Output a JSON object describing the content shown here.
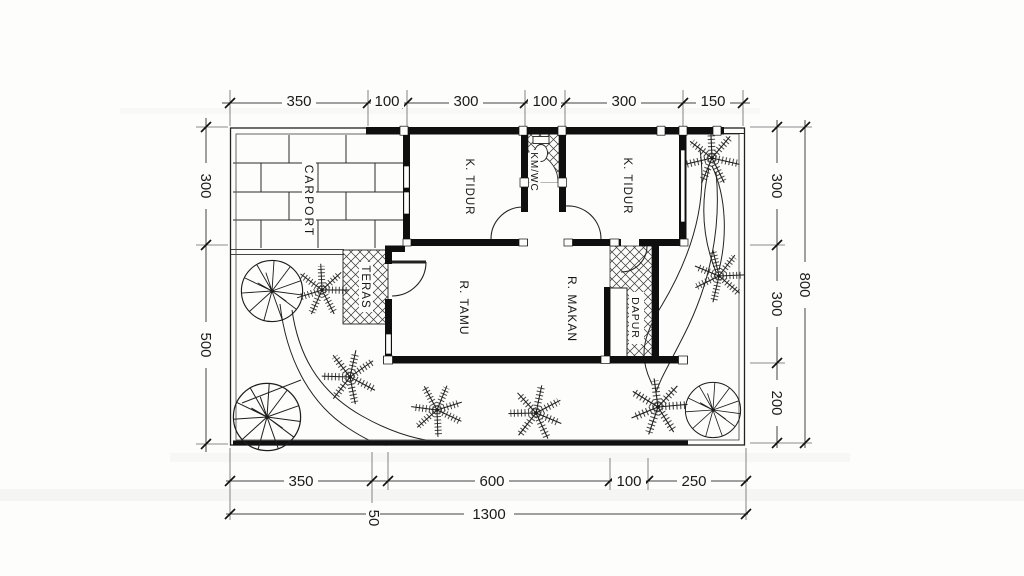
{
  "plan": {
    "rooms": [
      {
        "id": "carport",
        "label": "CARPORT"
      },
      {
        "id": "bedroom-left",
        "label": "K. TIDUR"
      },
      {
        "id": "bathroom",
        "label": "KM/WC"
      },
      {
        "id": "bedroom-right",
        "label": "K. TIDUR"
      },
      {
        "id": "terrace",
        "label": "TERAS"
      },
      {
        "id": "living-room",
        "label": "R. TAMU"
      },
      {
        "id": "dining-room",
        "label": "R. MAKAN"
      },
      {
        "id": "kitchen",
        "label": "DAPUR"
      }
    ],
    "dimensions": {
      "top": [
        "350",
        "100",
        "300",
        "100",
        "300",
        "150"
      ],
      "left": [
        "300",
        "500"
      ],
      "right_inner": [
        "300",
        "300",
        "200"
      ],
      "right_total": "800",
      "bottom": [
        "350",
        "600",
        "100",
        "250"
      ],
      "bottom_small": "50",
      "bottom_total": "1300"
    },
    "colors": {
      "ink": "#1c1c1c",
      "paper": "#fdfdfc"
    }
  }
}
